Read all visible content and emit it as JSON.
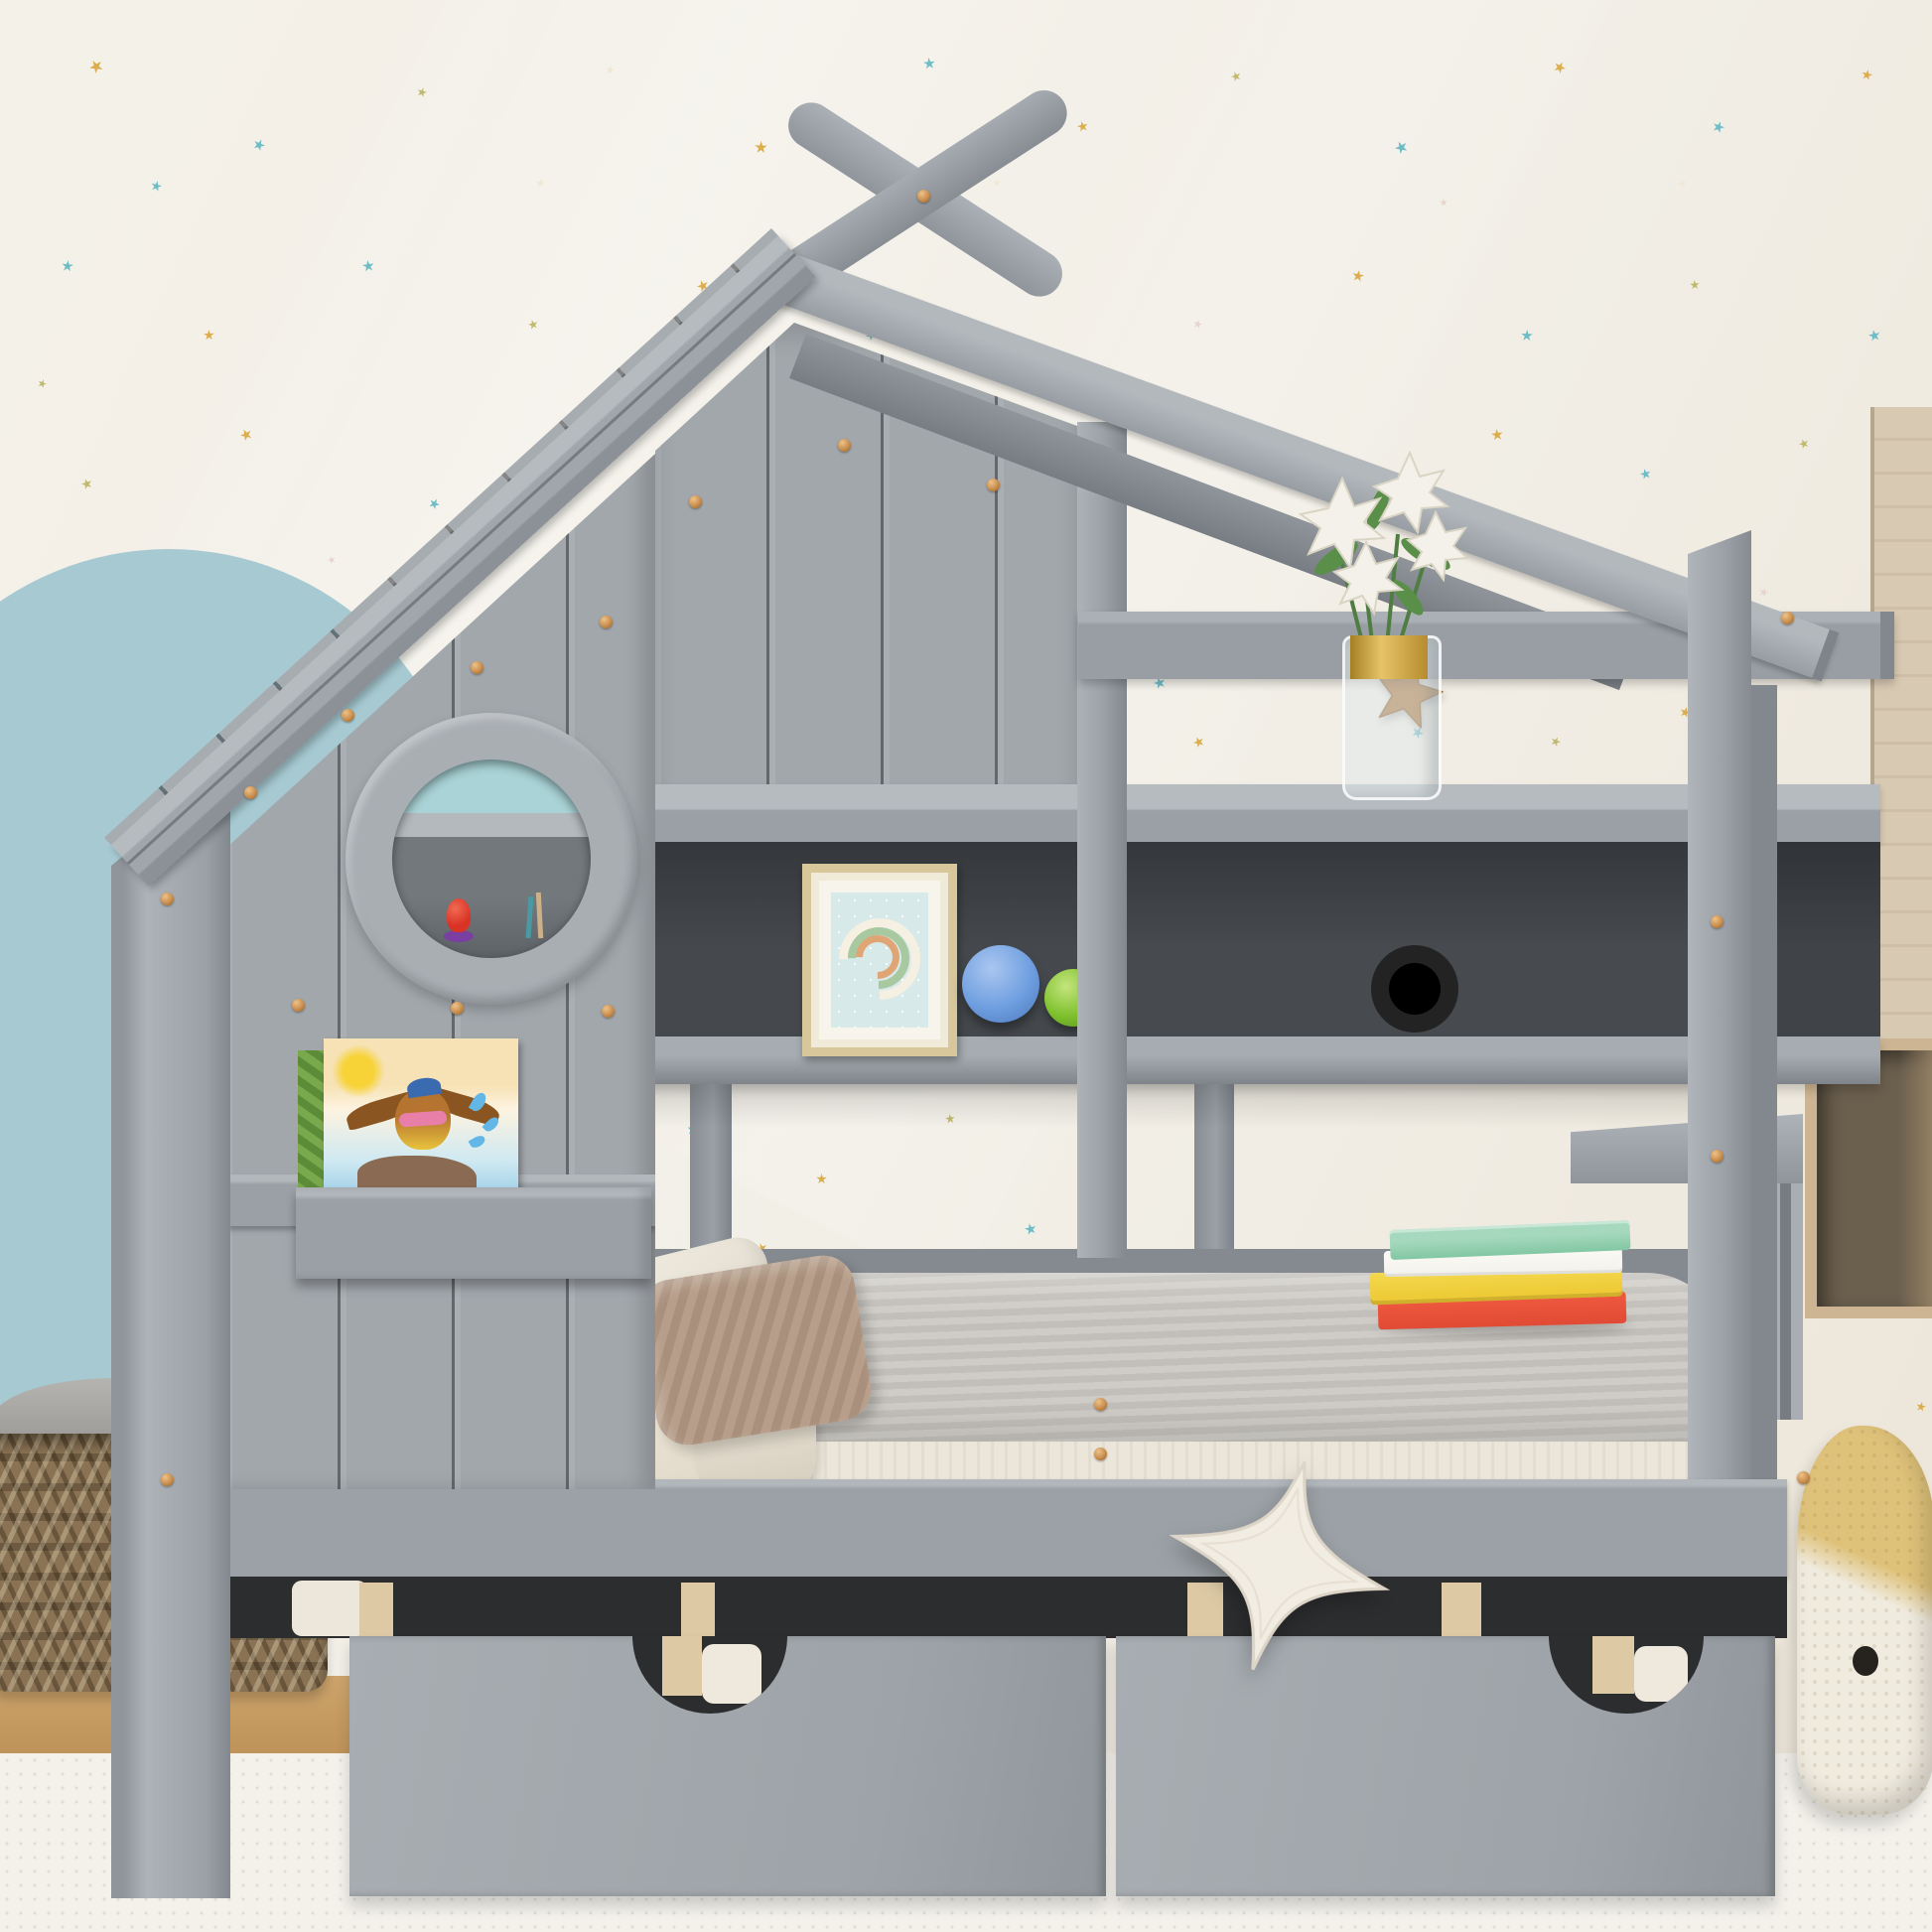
{
  "meta": {
    "domain": "natural-image",
    "subject": "Gray kids house-frame twin bed with roof finials, porthole window, bookshelf hutch and two storage drawers in a star-wallpaper nursery"
  },
  "palette": {
    "wall": "#f2efe7",
    "wallWarm": "#ece5d8",
    "arch": "#a7cad2",
    "bedGray": "#9ba1a6",
    "bedGrayLight": "#b0b5ba",
    "bedGrayDark": "#83898f",
    "seamDark": "#30343a",
    "shelfDark": "#3f4347",
    "gapDark": "#2c2d2f",
    "woodSlat": "#ddc9a4",
    "floorWood": "#c59a62",
    "rug": "#f3f1ea",
    "basket": "#8a7354",
    "basketDark": "#66543c",
    "basketFabric": "#a2a19d",
    "blanket": "#c9c6c1",
    "sheet": "#eae3d5",
    "mattress": "#ece6da",
    "pillowBrown": "#b29a86",
    "bookGreen": "#82c7a3",
    "bookWhite": "#f3f1eb",
    "bookYellow": "#ecc832",
    "bookRed": "#e14b35",
    "frameGold": "#d9c79c",
    "artBlue": "#d8e9ea",
    "ballBlue": "#6f9fe0",
    "ballGreen": "#7fc12e",
    "bikeWood": "#d9bd8e",
    "bikeRed": "#d64535",
    "navyStar": "#35495e",
    "caramelStar": "#a96f33",
    "whaleTan": "#dfc27a",
    "plushWhite": "#f2ede3",
    "copper": "#c98e4f",
    "starTeal": "#5fb7c2",
    "starGold": "#d9a53c",
    "starOlive": "#b9b461",
    "starPink": "#e6d0c9",
    "starCream": "#efe5d2",
    "woodShelfRight": "#d8c9b2",
    "portholeTeal": "#a9d3d6",
    "toyRed": "#d93325",
    "toyPurple": "#7a3fa0"
  },
  "objects": [
    "house-frame-bed",
    "crossed-roof-finials",
    "left-roof-fascia",
    "right-roof-rafter",
    "plank-wall-wing",
    "porthole-window",
    "window-toys",
    "book-ledge",
    "picture-book-bird",
    "storage-hutch",
    "rainbow-picture-frame",
    "toy-ball-blue",
    "toy-ball-green",
    "wooden-balance-bike",
    "lily-vase",
    "navy-star-wall-plush",
    "caramel-star-wall-plush",
    "bed-mattress",
    "gray-blanket",
    "white-pillow",
    "brown-striped-pillow",
    "stacked-books",
    "slatted-footboard",
    "storage-drawer-left",
    "storage-drawer-right",
    "white-star-pillow",
    "knitted-whale-plush",
    "wicker-basket",
    "blue-arch-wall-decal",
    "star-wallpaper",
    "wood-box-shelf",
    "wood-side-panel",
    "white-rug",
    "wood-floor"
  ],
  "stars": [
    [
      90,
      60,
      14,
      "starGold"
    ],
    [
      255,
      140,
      12,
      "starTeal"
    ],
    [
      420,
      88,
      10,
      "starOlive"
    ],
    [
      610,
      66,
      9,
      "starCream"
    ],
    [
      760,
      142,
      13,
      "starGold"
    ],
    [
      930,
      58,
      12,
      "starTeal"
    ],
    [
      1085,
      122,
      11,
      "starGold"
    ],
    [
      1240,
      72,
      10,
      "starOlive"
    ],
    [
      1405,
      142,
      13,
      "starTeal"
    ],
    [
      1565,
      62,
      12,
      "starGold"
    ],
    [
      1725,
      122,
      12,
      "starTeal"
    ],
    [
      1875,
      70,
      11,
      "starGold"
    ],
    [
      62,
      262,
      12,
      "starTeal"
    ],
    [
      205,
      332,
      11,
      "starGold"
    ],
    [
      365,
      262,
      12,
      "starTeal"
    ],
    [
      532,
      322,
      10,
      "starOlive"
    ],
    [
      702,
      282,
      12,
      "starGold"
    ],
    [
      872,
      332,
      11,
      "starTeal"
    ],
    [
      1032,
      262,
      12,
      "starGold"
    ],
    [
      1202,
      322,
      9,
      "starPink"
    ],
    [
      1362,
      272,
      12,
      "starGold"
    ],
    [
      1532,
      332,
      12,
      "starTeal"
    ],
    [
      1702,
      282,
      10,
      "starOlive"
    ],
    [
      1882,
      332,
      12,
      "starTeal"
    ],
    [
      82,
      482,
      11,
      "starOlive"
    ],
    [
      242,
      432,
      12,
      "starGold"
    ],
    [
      432,
      502,
      11,
      "starTeal"
    ],
    [
      38,
      382,
      9,
      "starOlive"
    ],
    [
      152,
      182,
      11,
      "starTeal"
    ],
    [
      1192,
      442,
      12,
      "starGold"
    ],
    [
      1342,
      482,
      11,
      "starTeal"
    ],
    [
      1502,
      432,
      12,
      "starGold"
    ],
    [
      1652,
      472,
      11,
      "starTeal"
    ],
    [
      1812,
      442,
      10,
      "starOlive"
    ],
    [
      1302,
      562,
      11,
      "starGold"
    ],
    [
      1602,
      562,
      10,
      "starOlive"
    ],
    [
      1772,
      592,
      9,
      "starPink"
    ],
    [
      1452,
      602,
      11,
      "starTeal"
    ],
    [
      702,
      692,
      12,
      "starTeal"
    ],
    [
      832,
      732,
      11,
      "starGold"
    ],
    [
      982,
      702,
      10,
      "starOlive"
    ],
    [
      1162,
      682,
      12,
      "starTeal"
    ],
    [
      1202,
      742,
      11,
      "starGold"
    ],
    [
      1422,
      732,
      12,
      "starTeal"
    ],
    [
      1562,
      742,
      10,
      "starOlive"
    ],
    [
      1692,
      712,
      11,
      "starGold"
    ],
    [
      692,
      1132,
      12,
      "starTeal"
    ],
    [
      822,
      1182,
      11,
      "starGold"
    ],
    [
      952,
      1122,
      10,
      "starOlive"
    ],
    [
      1032,
      1232,
      12,
      "starTeal"
    ],
    [
      762,
      1252,
      11,
      "starGold"
    ],
    [
      902,
      1262,
      9,
      "starPink"
    ],
    [
      1778,
      1212,
      11,
      "starGold"
    ],
    [
      1795,
      1362,
      10,
      "starTeal"
    ],
    [
      1930,
      1412,
      10,
      "starGold"
    ],
    [
      540,
      180,
      9,
      "starCream"
    ],
    [
      1000,
      180,
      8,
      "starCream"
    ],
    [
      1450,
      200,
      8,
      "starPink"
    ],
    [
      1690,
      180,
      9,
      "starCream"
    ],
    [
      330,
      560,
      8,
      "starPink"
    ]
  ],
  "screws": [
    [
      930,
      197
    ],
    [
      168,
      905
    ],
    [
      168,
      1490
    ],
    [
      350,
      720
    ],
    [
      480,
      672
    ],
    [
      610,
      626
    ],
    [
      300,
      1012
    ],
    [
      460,
      1015
    ],
    [
      612,
      1018
    ],
    [
      1108,
      1414
    ],
    [
      1108,
      1464
    ],
    [
      1729,
      928
    ],
    [
      1729,
      1164
    ],
    [
      1816,
      1488
    ],
    [
      1800,
      622
    ],
    [
      700,
      505
    ],
    [
      850,
      448
    ],
    [
      1000,
      488
    ],
    [
      252,
      798
    ]
  ]
}
